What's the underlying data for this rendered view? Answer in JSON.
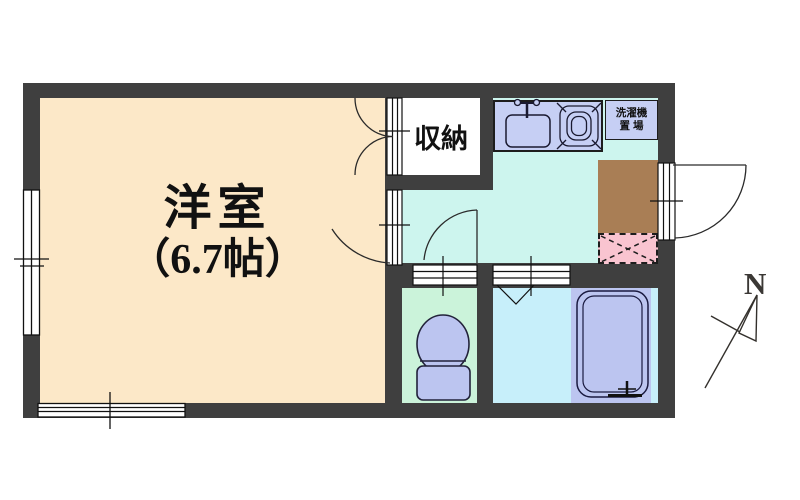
{
  "labels": {
    "main_room_line1": "洋室",
    "main_room_line2": "（6.7帖）",
    "closet": "収納",
    "laundry_line1": "洗濯機",
    "laundry_line2": "置 場",
    "compass_north": "N"
  },
  "colors": {
    "wall": "#3f3f3f",
    "main_room_floor": "#fce8c8",
    "kitchen_floor": "#cdf5ee",
    "toilet_floor": "#cbf3da",
    "bath_floor": "#c7effa",
    "fixture_periwinkle": "#bcc5f0",
    "counter_lavender": "#c6cff4",
    "genkan_brown": "#a97e55",
    "mat_pink": "#f9c4d0",
    "line": "#1d1d1d"
  }
}
